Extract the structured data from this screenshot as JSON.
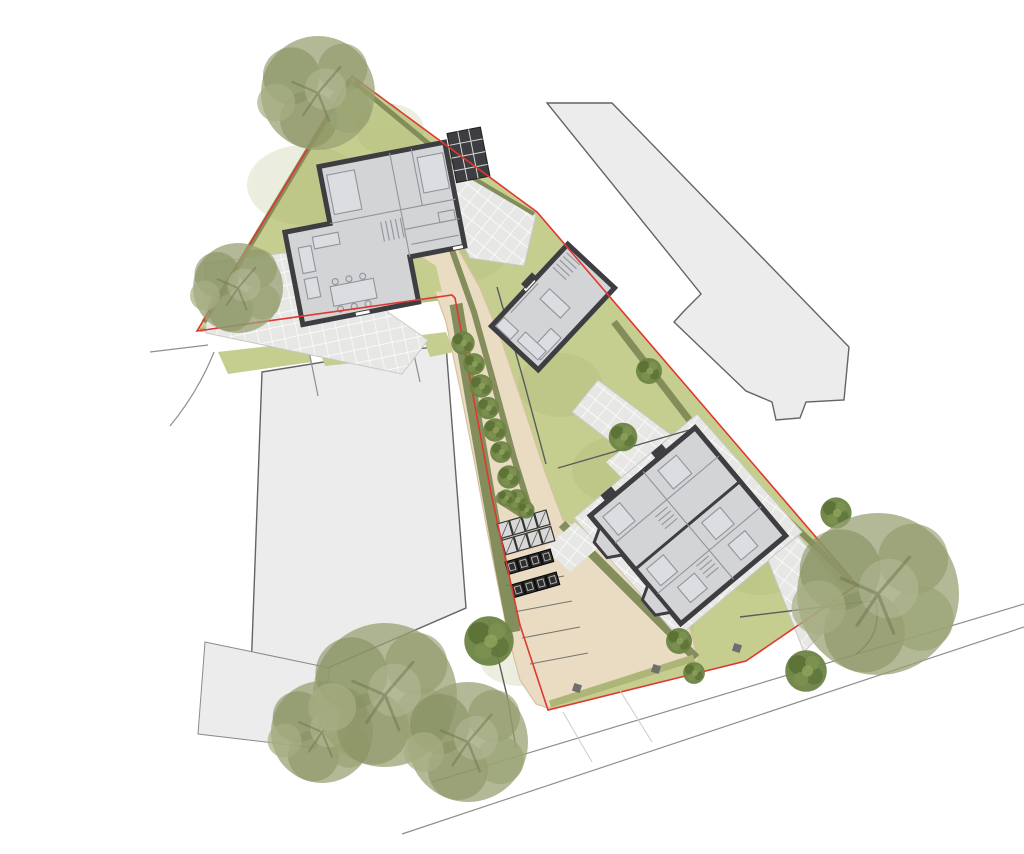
{
  "meta": {
    "title": "Residential development site plan",
    "drawing_type": "architectural landscape site plan, top-down",
    "has_text_labels": false
  },
  "colors": {
    "background": "#ffffff",
    "boundary": "#e03830",
    "lawn": "#c5cd8f",
    "lawn_dark": "#a9b573",
    "hedge_dark": "#7f8a58",
    "hedge_light": "#aab473",
    "driveway": "#eadcc3",
    "driveway_edge": "#d6c2a0",
    "paving": "#e7e7e5",
    "paving_joint": "#ffffff",
    "neighbor_fill": "#ececec",
    "house_wall": "#3d3d42",
    "house_floor": "#d3d4d6",
    "furniture_line": "#90949c",
    "tree_sage": "#9aa273",
    "tree_sage_dark": "#868f60",
    "tree_green": "#6d8443",
    "tree_green_dark": "#55692f",
    "road_line": "#8f8f8f",
    "fence": "#5c5c5c",
    "bin_dark": "#2e2e2e"
  },
  "site": {
    "boundary_style": "thin red line around triangular plot with access strip",
    "new_buildings": 3,
    "dwellings": 4,
    "building_kinds": [
      "detached house (north)",
      "detached house (middle)",
      "semi-detached pair (south-east)"
    ],
    "neighbor_buildings": 3,
    "parking_bay_dividers": 4,
    "street_tree_row_count": 8,
    "large_trees": 6,
    "small_garden_trees": 7,
    "bin_store_rows": 2,
    "cycle_stand_count": 8,
    "features": [
      "central driveway",
      "parking court",
      "bin and cycle stores",
      "hedgerows",
      "lawns",
      "paved patios",
      "garden fences",
      "perimeter road"
    ]
  }
}
